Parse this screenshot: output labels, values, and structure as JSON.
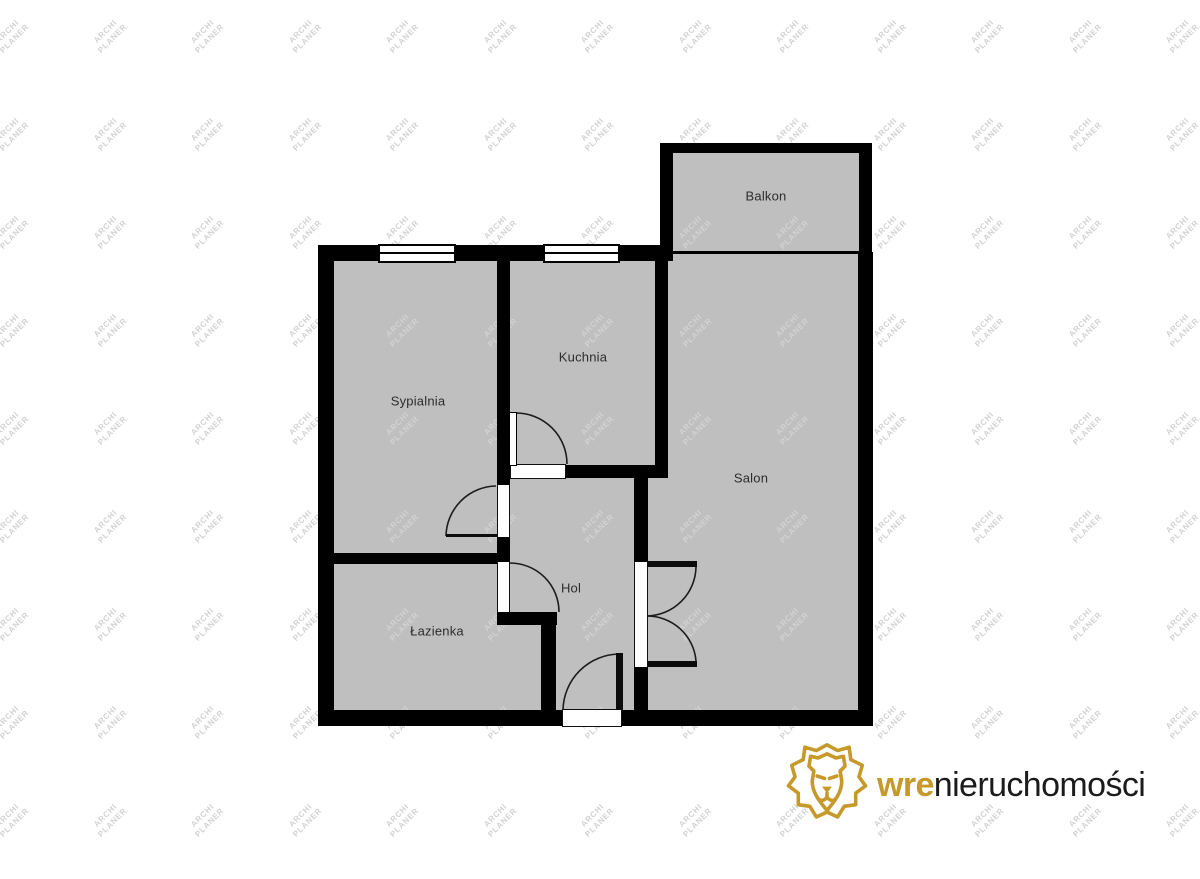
{
  "palette": {
    "background": "#ffffff",
    "wall": "#000000",
    "room_fill": "#bfbfbf",
    "label_text": "#2d2d2d",
    "watermark_gray": "#d2d2d2",
    "logo_gold": "#c6992b",
    "logo_text_dark": "#1b1b1b"
  },
  "watermark": {
    "line1": "ARCHI",
    "line2": "PLANER",
    "rotation_deg": -45,
    "cols": 13,
    "rows": 9,
    "start_x": 11,
    "start_y": 35,
    "step_x": 97.5,
    "step_y": 98
  },
  "logo": {
    "brand_bold": "wre",
    "brand_rest": "nieruchomości",
    "lion_icon": "gold-lion-head-icon"
  },
  "floorplan": {
    "rooms": [
      {
        "name": "Balkon",
        "label_x": 766,
        "label_y": 196
      },
      {
        "name": "Sypialnia",
        "label_x": 418,
        "label_y": 401
      },
      {
        "name": "Kuchnia",
        "label_x": 583,
        "label_y": 357
      },
      {
        "name": "Salon",
        "label_x": 751,
        "label_y": 478
      },
      {
        "name": "Hol",
        "label_x": 571,
        "label_y": 588
      },
      {
        "name": "Łazienka",
        "label_x": 437,
        "label_y": 631
      }
    ],
    "fills": [
      {
        "name": "apartment-floor",
        "x": 326,
        "y": 250,
        "w": 540,
        "h": 470
      },
      {
        "name": "balcony-floor",
        "x": 666,
        "y": 148,
        "w": 200,
        "h": 107
      }
    ],
    "walls": [
      {
        "name": "wall-top-main",
        "x": 318,
        "y": 245,
        "w": 355,
        "h": 16
      },
      {
        "name": "wall-left-main",
        "x": 318,
        "y": 245,
        "w": 16,
        "h": 481
      },
      {
        "name": "wall-bottom-main",
        "x": 318,
        "y": 710,
        "w": 555,
        "h": 16
      },
      {
        "name": "wall-right-main",
        "x": 858,
        "y": 252,
        "w": 15,
        "h": 474
      },
      {
        "name": "wall-balcony-left",
        "x": 660,
        "y": 143,
        "w": 13,
        "h": 112
      },
      {
        "name": "wall-balcony-top",
        "x": 660,
        "y": 143,
        "w": 212,
        "h": 10
      },
      {
        "name": "wall-balcony-right",
        "x": 859,
        "y": 143,
        "w": 13,
        "h": 110
      },
      {
        "name": "balcony-salon-divider",
        "x": 673,
        "y": 251,
        "w": 186,
        "h": 3
      },
      {
        "name": "wall-sypialnia-kuchnia",
        "x": 497,
        "y": 261,
        "w": 13,
        "h": 224
      },
      {
        "name": "wall-sypialnia-hol",
        "x": 497,
        "y": 537,
        "w": 13,
        "h": 25
      },
      {
        "name": "wall-sypialnia-lazienka",
        "x": 334,
        "y": 553,
        "w": 163,
        "h": 11
      },
      {
        "name": "wall-lazienka-stub",
        "x": 497,
        "y": 612,
        "w": 60,
        "h": 13
      },
      {
        "name": "wall-lazienka-right",
        "x": 541,
        "y": 625,
        "w": 15,
        "h": 85
      },
      {
        "name": "wall-kuchnia-bottom",
        "x": 565,
        "y": 465,
        "w": 103,
        "h": 13
      },
      {
        "name": "wall-kuchnia-salon",
        "x": 655,
        "y": 245,
        "w": 13,
        "h": 233
      },
      {
        "name": "wall-hol-salon-upper",
        "x": 634,
        "y": 465,
        "w": 14,
        "h": 97
      },
      {
        "name": "wall-hol-salon-lower",
        "x": 634,
        "y": 667,
        "w": 14,
        "h": 43
      }
    ],
    "windows": [
      {
        "name": "window-sypialnia",
        "x": 378,
        "y": 244,
        "w": 78,
        "h": 19
      },
      {
        "name": "window-kuchnia",
        "x": 543,
        "y": 244,
        "w": 77,
        "h": 19
      }
    ],
    "openings": [
      {
        "name": "kuchnia-door-threshold",
        "kind": "h",
        "x": 510,
        "y": 464,
        "w": 56,
        "h": 15
      },
      {
        "name": "entrance-door-threshold",
        "kind": "h",
        "x": 562,
        "y": 709,
        "w": 60,
        "h": 18
      },
      {
        "name": "sypialnia-door-opening",
        "kind": "v",
        "x": 497,
        "y": 485,
        "w": 13,
        "h": 52
      },
      {
        "name": "lazienka-door-opening",
        "kind": "v",
        "x": 497,
        "y": 562,
        "w": 13,
        "h": 50
      },
      {
        "name": "salon-double-door-opening",
        "kind": "v",
        "x": 634,
        "y": 562,
        "w": 14,
        "h": 105
      }
    ],
    "leaves": [
      {
        "name": "kuchnia-door-leaf",
        "style": "white",
        "x": 509,
        "y": 412,
        "w": 8,
        "h": 54
      },
      {
        "name": "sypialnia-door-leaf",
        "style": "black",
        "x": 446,
        "y": 534,
        "w": 51,
        "h": 3
      },
      {
        "name": "entrance-door-leaf",
        "style": "black",
        "x": 616,
        "y": 653,
        "w": 7,
        "h": 57
      },
      {
        "name": "salon-door-upper-leaf",
        "style": "black",
        "x": 648,
        "y": 561,
        "w": 49,
        "h": 6
      },
      {
        "name": "salon-door-lower-leaf",
        "style": "black",
        "x": 648,
        "y": 661,
        "w": 49,
        "h": 6
      }
    ],
    "arcs": [
      {
        "name": "kuchnia-door-arc",
        "d": "M516,413 A51,51 0 0 1 567,464"
      },
      {
        "name": "sypialnia-door-arc",
        "d": "M446,536 A51,51 0 0 1 496,486"
      },
      {
        "name": "lazienka-door-arc",
        "d": "M510,563 A49,49 0 0 1 559,612"
      },
      {
        "name": "entrance-door-arc",
        "d": "M619,654 A57,57 0 0 0 563,710"
      },
      {
        "name": "salon-door-upper-arc",
        "d": "M696,567 A50,50 0 0 1 647,616"
      },
      {
        "name": "salon-door-lower-arc",
        "d": "M696,661 A49,49 0 0 0 647,616"
      }
    ]
  }
}
